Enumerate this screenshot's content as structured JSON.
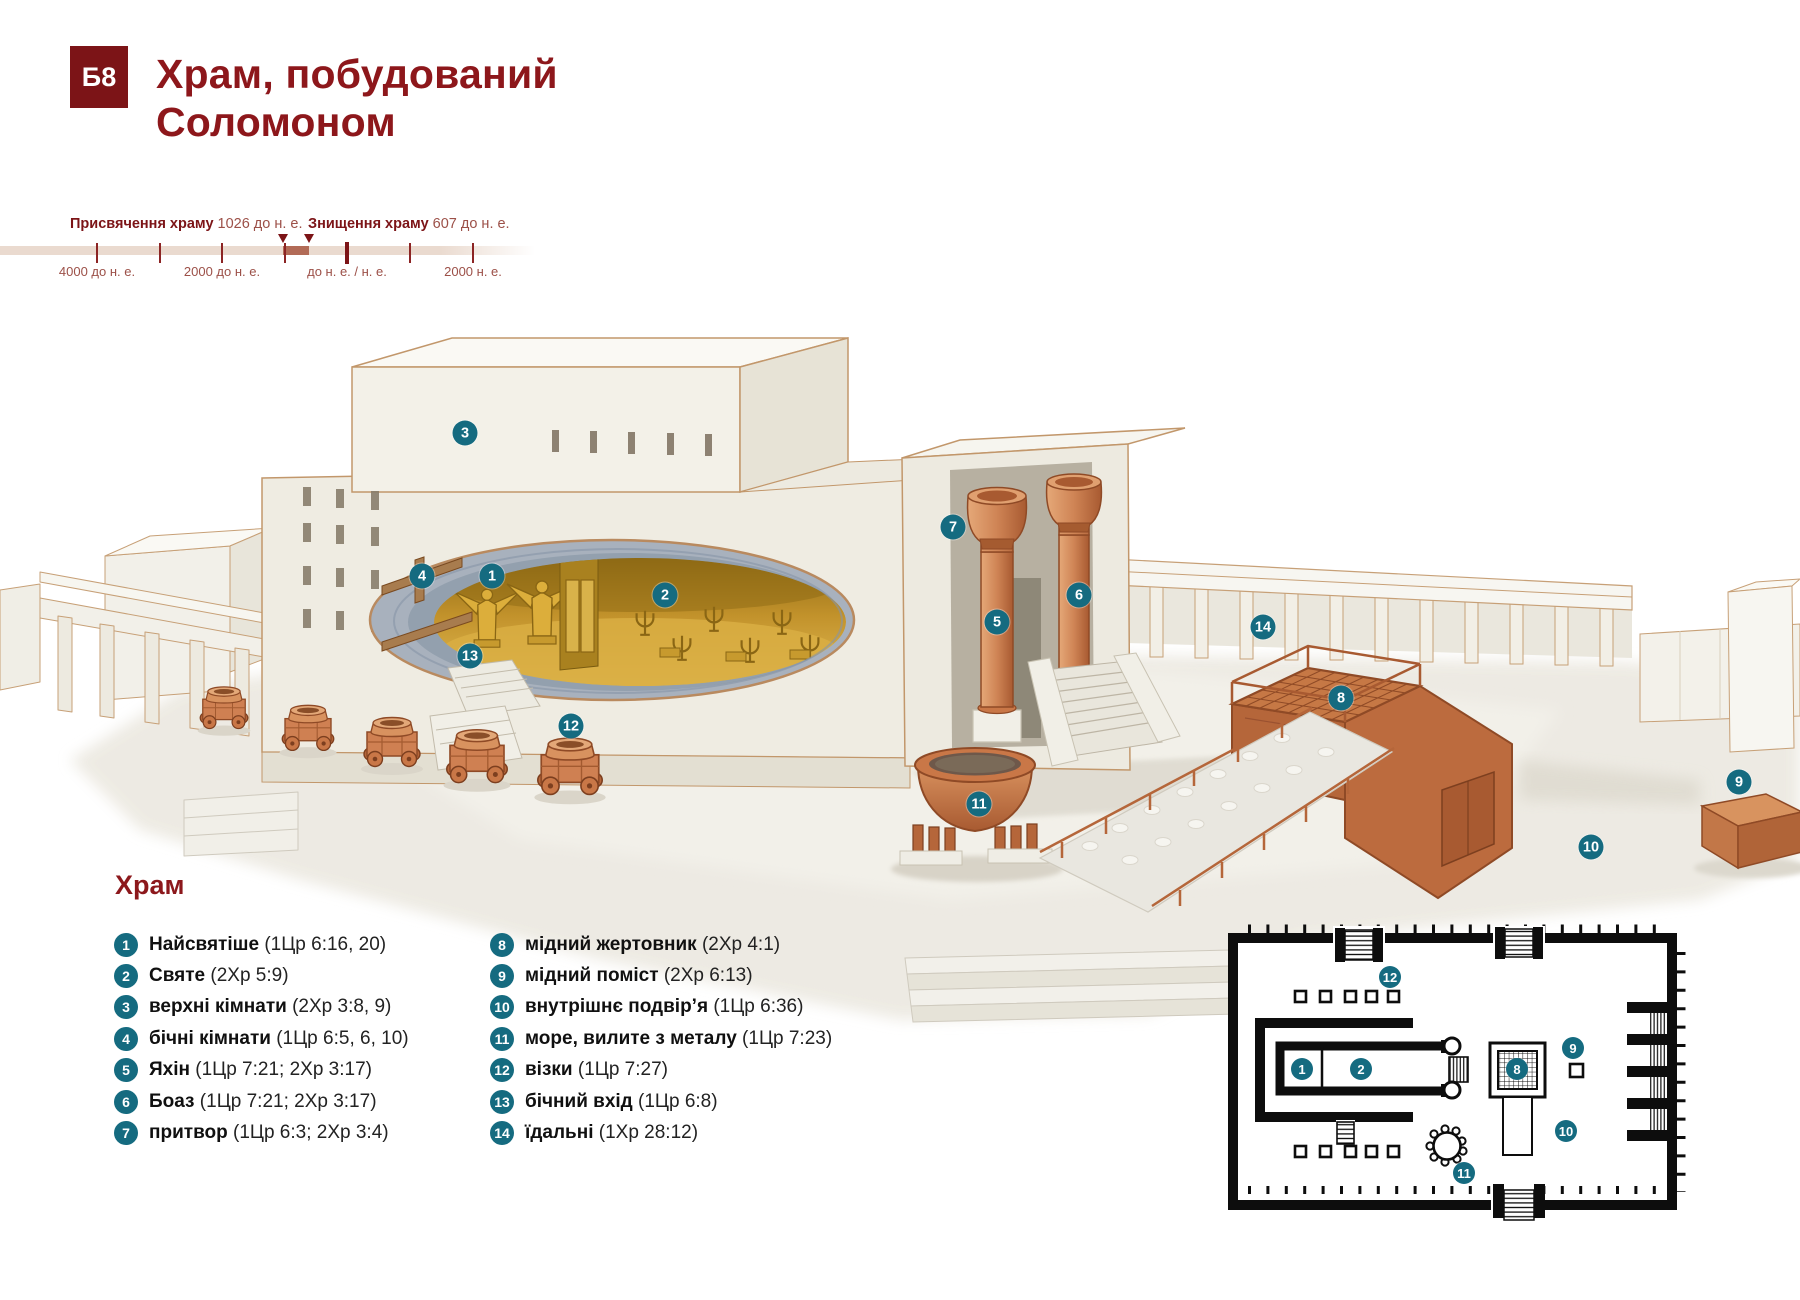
{
  "header": {
    "badge": "Б8",
    "title_line1": "Храм, побудований",
    "title_line2": "Соломоном"
  },
  "timeline": {
    "events": [
      {
        "label": "Присвячення храму",
        "year": "1026 до н. е.",
        "label_x": 70,
        "marker_x": 283
      },
      {
        "label": "Знищення храму",
        "year": "607 до н. е.",
        "label_x": 308,
        "marker_x": 309
      }
    ],
    "ticks": [
      {
        "x": 97
      },
      {
        "x": 159.5
      },
      {
        "x": 222
      },
      {
        "x": 284.5
      },
      {
        "x": 347,
        "major": true
      },
      {
        "x": 410
      },
      {
        "x": 473
      }
    ],
    "axis_labels": [
      {
        "text": "4000 до н. е.",
        "x": 97
      },
      {
        "text": "2000 до н. е.",
        "x": 222
      },
      {
        "text": "до н. е. / н. е.",
        "x": 347
      },
      {
        "text": "2000 н. е.",
        "x": 473
      }
    ],
    "highlight": {
      "x1": 283,
      "x2": 309
    },
    "bar": {
      "x": 0,
      "width": 535
    },
    "colors": {
      "bar": "#EADACF",
      "highlight": "#B26B57",
      "tick": "#8C2424",
      "accent": "#7C1417"
    }
  },
  "legend": {
    "heading": "Храм",
    "items": [
      {
        "num": "1",
        "label": "Найсвятіше",
        "ref": "(1Цр 6:16, 20)"
      },
      {
        "num": "2",
        "label": "Святе",
        "ref": "(2Хр 5:9)"
      },
      {
        "num": "3",
        "label": "верхні кімнати",
        "ref": "(2Хр 3:8, 9)"
      },
      {
        "num": "4",
        "label": "бічні кімнати",
        "ref": "(1Цр 6:5, 6, 10)"
      },
      {
        "num": "5",
        "label": "Яхін",
        "ref": "(1Цр 7:21; 2Хр 3:17)"
      },
      {
        "num": "6",
        "label": "Боаз",
        "ref": "(1Цр 7:21; 2Хр 3:17)"
      },
      {
        "num": "7",
        "label": "притвор",
        "ref": "(1Цр 6:3; 2Хр 3:4)"
      },
      {
        "num": "8",
        "label": "мідний жертовник",
        "ref": "(2Хр 4:1)"
      },
      {
        "num": "9",
        "label": "мідний поміст",
        "ref": "(2Хр 6:13)"
      },
      {
        "num": "10",
        "label": "внутрішнє подвір’я",
        "ref": "(1Цр 6:36)"
      },
      {
        "num": "11",
        "label": "море, вилите з металу",
        "ref": "(1Цр 7:23)"
      },
      {
        "num": "12",
        "label": "візки",
        "ref": "(1Цр 7:27)"
      },
      {
        "num": "13",
        "label": "бічний вхід",
        "ref": "(1Цр 6:8)"
      },
      {
        "num": "14",
        "label": "їдальні",
        "ref": "(1Хр 28:12)"
      }
    ]
  },
  "illustration": {
    "markers": [
      {
        "num": "1",
        "x": 492,
        "y": 576
      },
      {
        "num": "2",
        "x": 665,
        "y": 595
      },
      {
        "num": "3",
        "x": 465,
        "y": 433
      },
      {
        "num": "4",
        "x": 422,
        "y": 576
      },
      {
        "num": "5",
        "x": 997,
        "y": 622
      },
      {
        "num": "6",
        "x": 1079,
        "y": 595
      },
      {
        "num": "7",
        "x": 953,
        "y": 527
      },
      {
        "num": "8",
        "x": 1341,
        "y": 698
      },
      {
        "num": "9",
        "x": 1739,
        "y": 782
      },
      {
        "num": "10",
        "x": 1591,
        "y": 847
      },
      {
        "num": "11",
        "x": 979,
        "y": 804
      },
      {
        "num": "12",
        "x": 571,
        "y": 726
      },
      {
        "num": "13",
        "x": 470,
        "y": 656
      },
      {
        "num": "14",
        "x": 1263,
        "y": 627
      }
    ]
  },
  "floor_plan": {
    "markers": [
      {
        "num": "1",
        "x": 1302,
        "y": 1069
      },
      {
        "num": "2",
        "x": 1361,
        "y": 1069
      },
      {
        "num": "8",
        "x": 1517,
        "y": 1069
      },
      {
        "num": "9",
        "x": 1573,
        "y": 1048
      },
      {
        "num": "10",
        "x": 1566,
        "y": 1131
      },
      {
        "num": "11",
        "x": 1464,
        "y": 1173
      },
      {
        "num": "12",
        "x": 1390,
        "y": 977
      }
    ]
  },
  "colors": {
    "accent_maroon": "#8D171B",
    "badge_bg": "#7C1417",
    "marker_teal": "#156B80",
    "bronze": "#CF8455",
    "gold": "#C79A35"
  }
}
